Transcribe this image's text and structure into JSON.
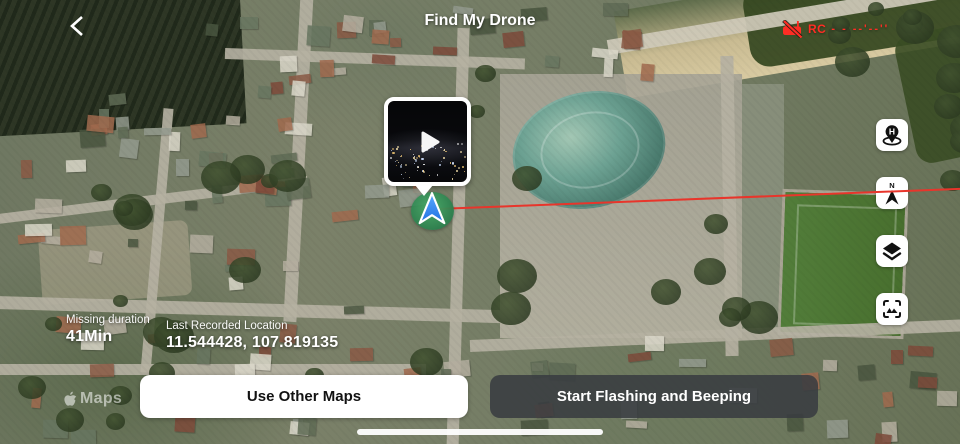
{
  "header": {
    "title": "Find My Drone",
    "rc_status": {
      "icon": "rc-disconnected-icon",
      "label": "RC",
      "signal_left": "- -",
      "signal_right": "--'--''",
      "color": "#ff2d24"
    }
  },
  "video_preview": {
    "play_icon": "play"
  },
  "map": {
    "type": "satellite",
    "watermark": "Maps",
    "path_color": "#e8352b",
    "marker_arrow_color": "#2f86f6",
    "marker_halo_color": "#2e9c5c"
  },
  "map_controls": [
    {
      "name": "home-point",
      "icon": "home-point-icon",
      "label": "H"
    },
    {
      "name": "compass",
      "icon": "compass-north-icon",
      "label": "N"
    },
    {
      "name": "layers",
      "icon": "layers-icon"
    },
    {
      "name": "center-focus",
      "icon": "center-focus-icon"
    }
  ],
  "info": {
    "missing_duration_label": "Missing duration",
    "missing_duration_value": "41Min",
    "last_location_label": "Last Recorded Location",
    "last_location_value": "11.544428, 107.819135"
  },
  "actions": {
    "use_other_maps_label": "Use Other Maps",
    "start_flashing_label": "Start Flashing and Beeping"
  }
}
